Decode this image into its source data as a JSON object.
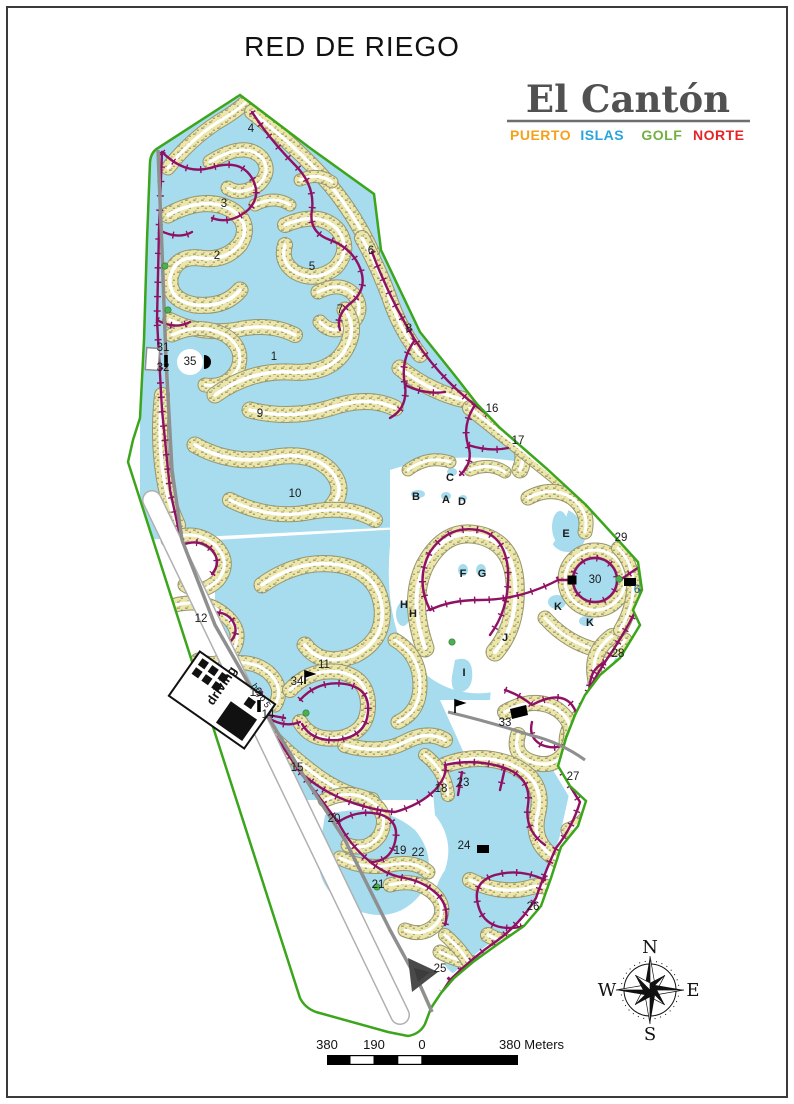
{
  "title": "RED DE RIEGO",
  "logo": {
    "name": "El Cantón",
    "name_color": "#515151",
    "subwords": [
      {
        "text": "PUERTO",
        "color": "#F5A21B"
      },
      {
        "text": "ISLAS",
        "color": "#29A5DC"
      },
      {
        "text": "GOLF",
        "color": "#72B043"
      },
      {
        "text": "NORTE",
        "color": "#E52629"
      }
    ]
  },
  "compass": {
    "north": "N",
    "east": "E",
    "south": "S",
    "west": "W"
  },
  "scale_bar": {
    "left_label": "380",
    "mid_label": "190",
    "zero_label": "0",
    "right_label": "380 Meters"
  },
  "map": {
    "colors": {
      "water": "#a6dcee",
      "parcels": "#ece6a8",
      "irrigation": "#8F1163",
      "boundary": "#3BA51B",
      "road": "#8f8f8f",
      "label": "#1a1a1a",
      "teal_label": "#0e6c85",
      "marker_green": "#4caf50"
    },
    "area_labels": [
      {
        "t": "1",
        "x": 274,
        "y": 360
      },
      {
        "t": "2",
        "x": 217,
        "y": 259
      },
      {
        "t": "3",
        "x": 224,
        "y": 207
      },
      {
        "t": "4",
        "x": 251,
        "y": 132
      },
      {
        "t": "5",
        "x": 312,
        "y": 270
      },
      {
        "t": "6",
        "x": 371,
        "y": 254
      },
      {
        "t": "7",
        "x": 340,
        "y": 313
      },
      {
        "t": "8",
        "x": 409,
        "y": 332
      },
      {
        "t": "9",
        "x": 260,
        "y": 417
      },
      {
        "t": "10",
        "x": 295,
        "y": 497
      },
      {
        "t": "11",
        "x": 324,
        "y": 668
      },
      {
        "t": "12",
        "x": 201,
        "y": 622
      },
      {
        "t": "13",
        "x": 256,
        "y": 696
      },
      {
        "t": "14",
        "x": 268,
        "y": 718
      },
      {
        "t": "15",
        "x": 297,
        "y": 771
      },
      {
        "t": "16",
        "x": 492,
        "y": 412
      },
      {
        "t": "17",
        "x": 518,
        "y": 444
      },
      {
        "t": "18",
        "x": 441,
        "y": 792
      },
      {
        "t": "19",
        "x": 400,
        "y": 854
      },
      {
        "t": "20",
        "x": 334,
        "y": 822
      },
      {
        "t": "21",
        "x": 378,
        "y": 888
      },
      {
        "t": "22",
        "x": 418,
        "y": 856
      },
      {
        "t": "23",
        "x": 463,
        "y": 786
      },
      {
        "t": "24",
        "x": 464,
        "y": 849
      },
      {
        "t": "25",
        "x": 440,
        "y": 972
      },
      {
        "t": "26",
        "x": 533,
        "y": 910
      },
      {
        "t": "27",
        "x": 573,
        "y": 780
      },
      {
        "t": "28",
        "x": 618,
        "y": 657
      },
      {
        "t": "29",
        "x": 621,
        "y": 541
      },
      {
        "t": "30",
        "x": 595,
        "y": 583
      },
      {
        "t": "31",
        "x": 163,
        "y": 351
      },
      {
        "t": "32",
        "x": 163,
        "y": 371
      },
      {
        "t": "33",
        "x": 505,
        "y": 726
      },
      {
        "t": "34",
        "x": 297,
        "y": 685
      },
      {
        "t": "35",
        "x": 190,
        "y": 365
      },
      {
        "t": "6",
        "x": 637,
        "y": 593,
        "teal": true
      },
      {
        "t": "A",
        "x": 446,
        "y": 503,
        "letter": true
      },
      {
        "t": "B",
        "x": 416,
        "y": 500,
        "letter": true
      },
      {
        "t": "C",
        "x": 450,
        "y": 481,
        "letter": true
      },
      {
        "t": "D",
        "x": 462,
        "y": 505,
        "letter": true
      },
      {
        "t": "E",
        "x": 566,
        "y": 537,
        "letter": true
      },
      {
        "t": "F",
        "x": 463,
        "y": 577,
        "letter": true
      },
      {
        "t": "G",
        "x": 482,
        "y": 577,
        "letter": true
      },
      {
        "t": "H",
        "x": 404,
        "y": 608,
        "letter": true
      },
      {
        "t": "H",
        "x": 413,
        "y": 617,
        "letter": true
      },
      {
        "t": "I",
        "x": 464,
        "y": 676,
        "letter": true
      },
      {
        "t": "J",
        "x": 505,
        "y": 641,
        "letter": true
      },
      {
        "t": "K",
        "x": 558,
        "y": 610,
        "letter": true
      },
      {
        "t": "K",
        "x": 590,
        "y": 626,
        "letter": true
      }
    ],
    "annotations": [
      {
        "text": "driving",
        "x": 213,
        "y": 706,
        "rot": -56,
        "size": 13,
        "bold": true
      },
      {
        "text": "hoyo 5",
        "x": 251,
        "y": 686,
        "rot": 56,
        "size": 9,
        "bold": false
      }
    ],
    "icons": [
      {
        "name": "water-intake-icon",
        "shape": "half-disc",
        "x": 204,
        "y": 362
      },
      {
        "name": "valve-icon",
        "shape": "bar",
        "x": 166,
        "y": 361
      },
      {
        "name": "pump-flag-icon",
        "shape": "flag",
        "x": 305,
        "y": 678
      },
      {
        "name": "valve-icon",
        "shape": "bar",
        "x": 259,
        "y": 706
      },
      {
        "name": "pump-flag-icon",
        "shape": "flag",
        "x": 455,
        "y": 707
      },
      {
        "name": "gate-icon",
        "shape": "para",
        "x": 518,
        "y": 712
      },
      {
        "name": "pump-station-icon",
        "shape": "rect",
        "x": 483,
        "y": 849
      },
      {
        "name": "pump-station-icon",
        "shape": "square",
        "x": 572,
        "y": 580
      },
      {
        "name": "outlet-icon",
        "shape": "rect",
        "x": 630,
        "y": 582
      },
      {
        "name": "entrance-icon",
        "shape": "triangle",
        "x": 422,
        "y": 974
      }
    ],
    "markers": [
      {
        "x": 619,
        "y": 579
      },
      {
        "x": 306,
        "y": 713
      },
      {
        "x": 377,
        "y": 887
      },
      {
        "x": 165,
        "y": 266
      },
      {
        "x": 168,
        "y": 310
      },
      {
        "x": 452,
        "y": 642
      }
    ]
  }
}
